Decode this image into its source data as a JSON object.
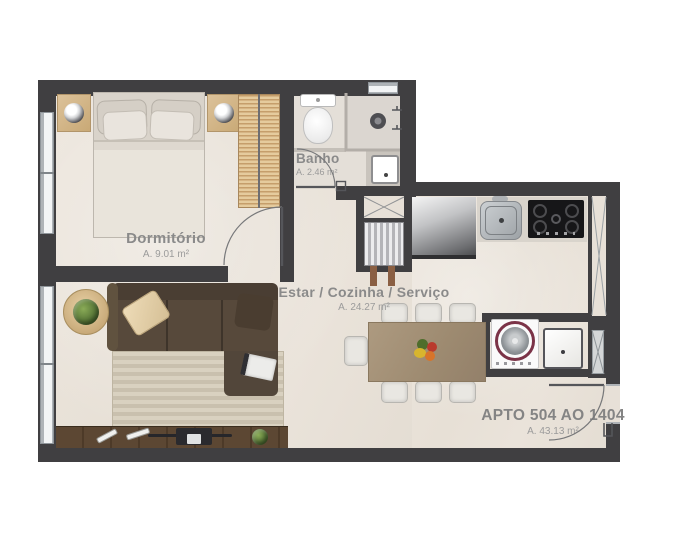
{
  "plan_title": "APTO 504 AO 1404",
  "apartment": {
    "label": "APTO 504 AO 1404",
    "area": "A. 43.13 m²"
  },
  "rooms": {
    "bedroom": {
      "label": "Dormitório",
      "area": "A. 9.01 m²"
    },
    "bathroom": {
      "label": "Banho",
      "area": "A. 2.46 m²"
    },
    "living": {
      "label": "Estar / Cozinha / Serviço",
      "area": "A. 24.27 m²"
    }
  },
  "colors": {
    "wall": "#403f41",
    "floor": "#e9e2d8",
    "label_text": "#8a8a8a",
    "washer_accent": "#7b3347",
    "sofa": "#57493b",
    "wood_furniture": "#d0b183",
    "tv_console": "#55412e"
  },
  "fixtures": [
    "double-bed",
    "nightstand-left",
    "nightstand-right",
    "wardrobe",
    "toilet",
    "shower",
    "bathroom-sink",
    "refrigerator",
    "kitchen-sink",
    "cooktop",
    "dining-table",
    "dining-chairs",
    "fruit-bowl",
    "sofa",
    "rug",
    "side-table",
    "tv-console",
    "tv",
    "washing-machine",
    "laundry-tub",
    "water-heater",
    "shafts"
  ]
}
